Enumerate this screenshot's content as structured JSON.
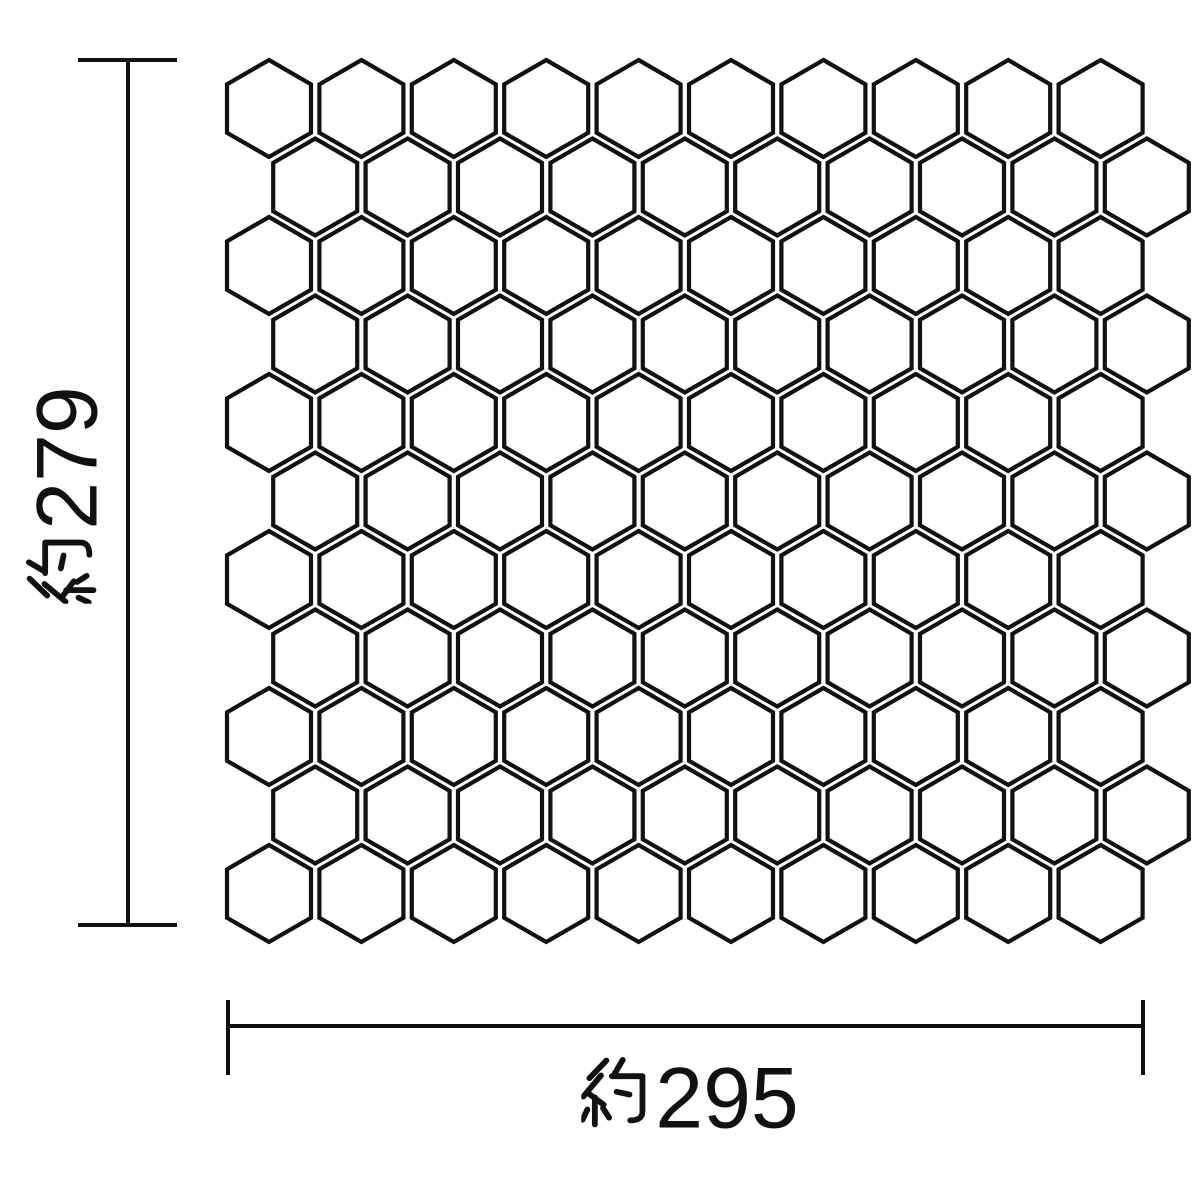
{
  "diagram": {
    "background_color": "#ffffff",
    "line_color": "#111111",
    "height_dimension": {
      "label": "約279",
      "kanji_prefix": "約",
      "value": "279",
      "orientation": "vertical"
    },
    "width_dimension": {
      "label": "約295",
      "kanji_prefix": "約",
      "value": "295",
      "orientation": "horizontal"
    },
    "hex_grid": {
      "rows": 11,
      "cols": 10,
      "total_tiles": 110,
      "hex_width": 84,
      "hex_height": 97,
      "pitch_x": 92.4,
      "pitch_y": 78.5,
      "origin_x": 227,
      "origin_y": 60,
      "even_row_offset_x": 46.2,
      "tile_fill": "#ffffff",
      "tile_stroke_width": 4.2
    }
  }
}
